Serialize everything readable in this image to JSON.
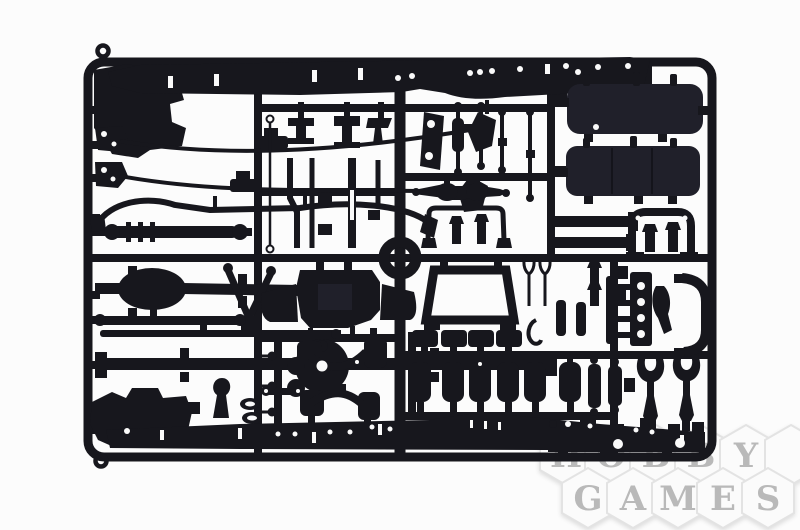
{
  "photo": {
    "subject_label": "plastic model sprue"
  },
  "colors": {
    "background": "#fcfcfc",
    "plastic": "#17171d",
    "plastic_soft": "#20202a",
    "hole": "#fafafa",
    "watermark_hex_fill": "#fbfbfb",
    "watermark_hex_stroke": "#e3e3e3",
    "watermark_letter": "#b9b9b9"
  },
  "watermark": {
    "brand_text": "HOBBY GAMES",
    "rows": [
      {
        "letters": [
          "H",
          "O",
          "B",
          "B",
          "Y"
        ]
      },
      {
        "letters": [
          "G",
          "A",
          "M",
          "E",
          "S"
        ]
      }
    ]
  }
}
